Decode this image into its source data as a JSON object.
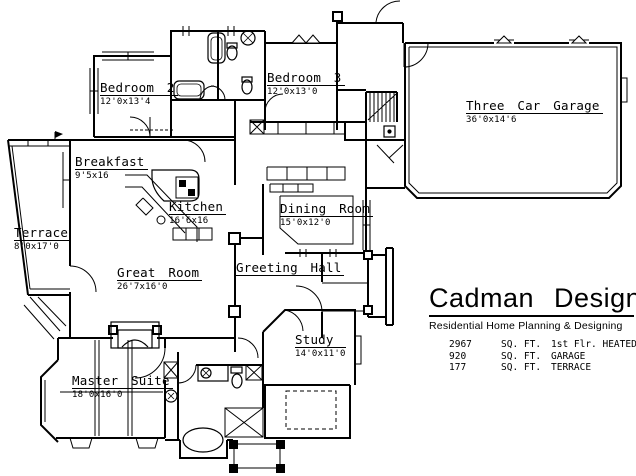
{
  "document": {
    "type": "residential floor plan drawing"
  },
  "rooms": [
    {
      "id": "bedroom-2",
      "name": "Bedroom 2",
      "dims": "12'0x13'4"
    },
    {
      "id": "bedroom-3",
      "name": "Bedroom 3",
      "dims": "12'0x13'0"
    },
    {
      "id": "three-car-garage",
      "name": "Three Car Garage",
      "dims": "36'0x14'6"
    },
    {
      "id": "breakfast",
      "name": "Breakfast",
      "dims": "9'5x16"
    },
    {
      "id": "kitchen",
      "name": "Kitchen",
      "dims": "16'6x16"
    },
    {
      "id": "dining-room",
      "name": "Dining Room",
      "dims": "15'0x12'0"
    },
    {
      "id": "terrace",
      "name": "Terrace",
      "dims": "8'0x17'0"
    },
    {
      "id": "great-room",
      "name": "Great Room",
      "dims": "26'7x16'0"
    },
    {
      "id": "greeting-hall",
      "name": "Greeting Hall",
      "dims": ""
    },
    {
      "id": "study",
      "name": "Study",
      "dims": "14'0x11'0"
    },
    {
      "id": "master-suite",
      "name": "Master Suite",
      "dims": "18'0x16'0"
    }
  ],
  "brand": {
    "name": "Cadman Designs",
    "tagline": "Residential Home Planning & Designing",
    "areas": [
      {
        "value": "2967",
        "unit": "SQ. FT.",
        "label": "1st Flr. HEATED"
      },
      {
        "value": "920",
        "unit": "SQ. FT.",
        "label": "GARAGE"
      },
      {
        "value": "177",
        "unit": "SQ. FT.",
        "label": "TERRACE"
      }
    ]
  },
  "colors": {
    "ink": "#000000",
    "paper": "#ffffff"
  }
}
